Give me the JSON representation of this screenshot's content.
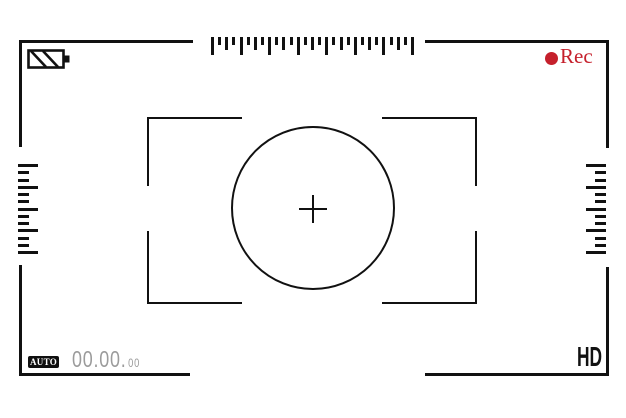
{
  "illustration": {
    "title": "camera viewfinder recording screen"
  },
  "colors": {
    "frame": "#111111",
    "rec_red": "#c5202c",
    "timer_gray": "#9b9b9b",
    "badge_bg": "#101010",
    "badge_fg": "#ffffff",
    "background": "#ffffff"
  },
  "top_bar": {
    "battery_icon": "battery-striped-icon",
    "rec": {
      "dot_icon": "record-dot",
      "label": "Rec"
    }
  },
  "rulers": {
    "top": {
      "orientation": "horizontal",
      "tick_count": 29,
      "pattern": [
        "long",
        "short",
        "medium",
        "short"
      ],
      "long_px": 18,
      "medium_px": 13,
      "short_px": 8
    },
    "left": {
      "orientation": "vertical",
      "tick_count": 13,
      "pattern": [
        "long",
        "short",
        "short"
      ],
      "long_px": 20,
      "medium_px": 15,
      "short_px": 11
    },
    "right": {
      "orientation": "vertical",
      "tick_count": 13,
      "pattern": [
        "long",
        "short",
        "short"
      ],
      "long_px": 20,
      "medium_px": 15,
      "short_px": 11
    }
  },
  "focus": {
    "circle_icon": "focus-circle",
    "reticle_icon": "crosshair"
  },
  "bottom_bar": {
    "auto_label": "AUTO",
    "timer": {
      "main": "00.00.",
      "sub": "00"
    },
    "hd_label": "HD"
  }
}
